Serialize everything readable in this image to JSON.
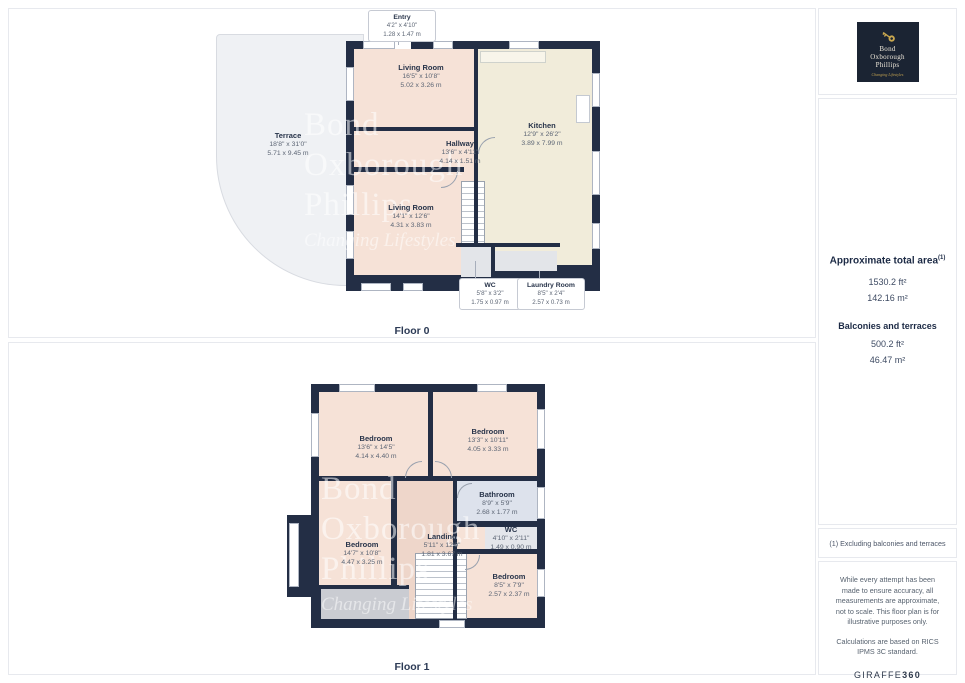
{
  "floor0": {
    "label": "Floor 0",
    "rooms": [
      {
        "name": "Living Room",
        "imperial": "16'5\" x 10'8\"",
        "metric": "5.02 x 3.26 m"
      },
      {
        "name": "Kitchen",
        "imperial": "12'9\" x 26'2\"",
        "metric": "3.89 x 7.99 m"
      },
      {
        "name": "Hallway",
        "imperial": "13'6\" x 4'11\"",
        "metric": "4.14 x 1.51 m"
      },
      {
        "name": "Living Room",
        "imperial": "14'1\" x 12'6\"",
        "metric": "4.31 x 3.83 m"
      },
      {
        "name": "Terrace",
        "imperial": "18'8\" x 31'0\"",
        "metric": "5.71 x 9.45 m"
      }
    ],
    "callouts": [
      {
        "name": "Entry",
        "imperial": "4'2\" x 4'10\"",
        "metric": "1.28 x 1.47 m"
      },
      {
        "name": "WC",
        "imperial": "5'8\" x 3'2\"",
        "metric": "1.75 x 0.97 m"
      },
      {
        "name": "Laundry Room",
        "imperial": "8'5\" x 2'4\"",
        "metric": "2.57 x 0.73 m"
      }
    ]
  },
  "floor1": {
    "label": "Floor 1",
    "rooms": [
      {
        "name": "Bedroom",
        "imperial": "13'6\" x 14'5\"",
        "metric": "4.14 x 4.40 m"
      },
      {
        "name": "Bedroom",
        "imperial": "13'3\" x 10'11\"",
        "metric": "4.05 x 3.33 m"
      },
      {
        "name": "Bathroom",
        "imperial": "8'9\" x 5'9\"",
        "metric": "2.68 x 1.77 m"
      },
      {
        "name": "WC",
        "imperial": "4'10\" x 2'11\"",
        "metric": "1.49 x 0.90 m"
      },
      {
        "name": "Bedroom",
        "imperial": "14'7\" x 10'8\"",
        "metric": "4.47 x 3.25 m"
      },
      {
        "name": "Landing",
        "imperial": "5'11\" x 12'0\"",
        "metric": "1.81 x 3.67 m"
      },
      {
        "name": "Bedroom",
        "imperial": "8'5\" x 7'9\"",
        "metric": "2.57 x 2.37 m"
      }
    ]
  },
  "watermark": {
    "line1": "Bond",
    "line2": "Oxborough",
    "line3": "Phillips",
    "tagline": "Changing Lifestyles"
  },
  "logo": {
    "line1": "Bond",
    "line2": "Oxborough",
    "line3": "Phillips",
    "tagline": "Changing Lifestyles"
  },
  "sidebar": {
    "total_title": "Approximate total area",
    "total_sup": "(1)",
    "total_ft": "1530.2 ft²",
    "total_m": "142.16 m²",
    "balconies_title": "Balconies and terraces",
    "balconies_ft": "500.2 ft²",
    "balconies_m": "46.47 m²",
    "footnote": "(1) Excluding balconies and terraces",
    "disclaimer1": "While every attempt has been made to ensure accuracy, all measurements are approximate, not to scale. This floor plan is for illustrative purposes only.",
    "disclaimer2": "Calculations are based on RICS IPMS 3C standard.",
    "brand_normal": "GIRAFFE",
    "brand_bold": "360"
  },
  "colors": {
    "wall_navy": "#232e45",
    "room_peach": "#f6e2d7",
    "kitchen_cream": "#f1ecda",
    "bathroom_blue": "#dde2ec",
    "landing_peach": "#eed6ca",
    "terrace_gray": "#eff1f4",
    "balcony_gray": "#caccd2",
    "brand_navy": "#1b2433",
    "brand_gold": "#bfa050"
  }
}
